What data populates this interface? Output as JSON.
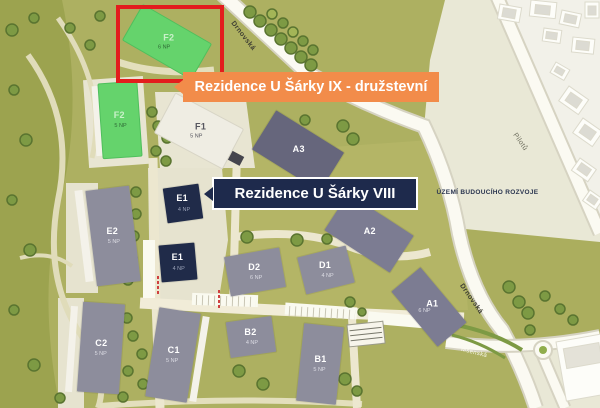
{
  "banners": {
    "ix": "Rezidence U Šárky IX - družstevní",
    "viii": "Rezidence U Šárky VIII"
  },
  "future_area_label": "ÚZEMÍ BUDOUCÍHO ROZVOJE",
  "roads": {
    "drnovska_top": "Drnovská",
    "pilotu": "Pilotů",
    "drnovska_right": "Drnovská",
    "msenska": "Mšenská"
  },
  "buildings": {
    "f2_top": {
      "id": "F2",
      "floors": "6 NP"
    },
    "f2_left": {
      "id": "F2",
      "floors": "5 NP"
    },
    "f1": {
      "id": "F1",
      "floors": "5 NP"
    },
    "a3": {
      "id": "A3",
      "floors": ""
    },
    "e2": {
      "id": "E2",
      "floors": "5 NP"
    },
    "e1_upper": {
      "id": "E1",
      "floors": "4 NP"
    },
    "e1_lower": {
      "id": "E1",
      "floors": "4 NP"
    },
    "d2": {
      "id": "D2",
      "floors": "6 NP"
    },
    "d1": {
      "id": "D1",
      "floors": "4 NP"
    },
    "a2": {
      "id": "A2",
      "floors": ""
    },
    "a1": {
      "id": "A1",
      "floors": "6 NP"
    },
    "c2": {
      "id": "C2",
      "floors": "5 NP"
    },
    "c1": {
      "id": "C1",
      "floors": "5 NP"
    },
    "b2": {
      "id": "B2",
      "floors": "4 NP"
    },
    "b1": {
      "id": "B1",
      "floors": "5 NP"
    }
  },
  "colors": {
    "banner_orange": "#f28c4a",
    "banner_navy": "#1e2a4c",
    "highlight_red": "#e31d1d",
    "new_phase_green": "#65d36c",
    "existing_gray": "#8d8d9c",
    "site_olive": "#adb061"
  }
}
